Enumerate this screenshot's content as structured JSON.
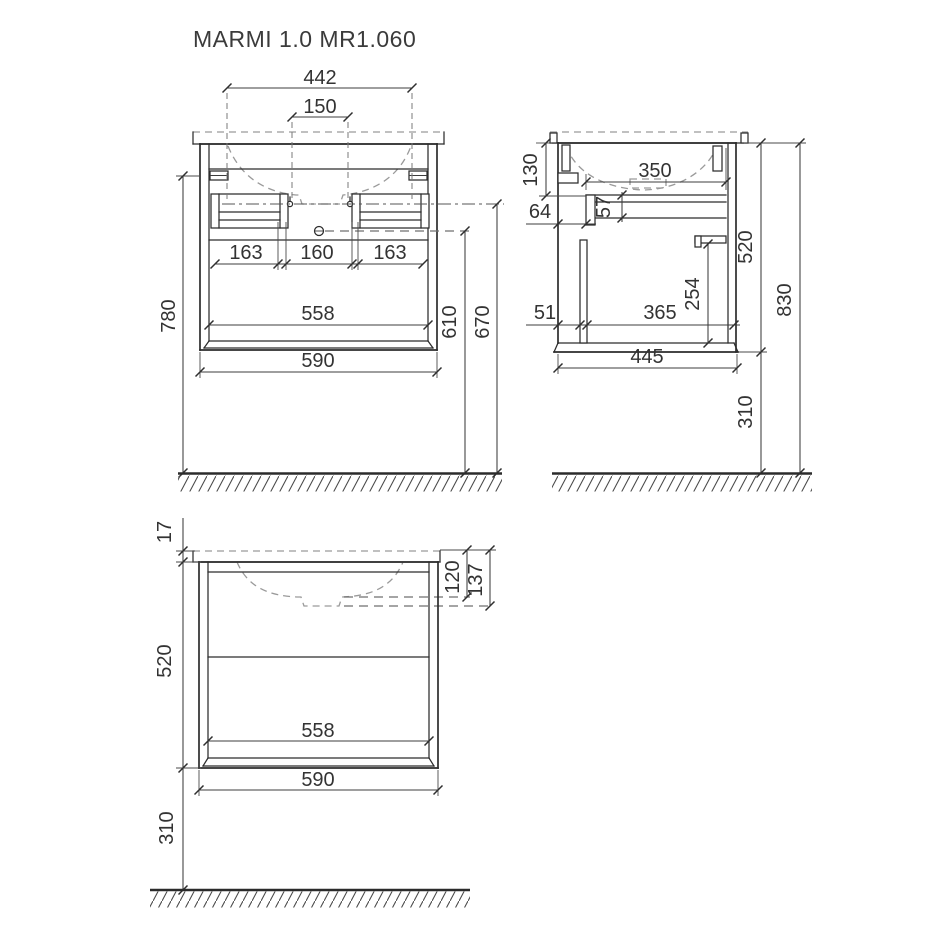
{
  "title": "MARMI 1.0 MR1.060",
  "front": {
    "d442": "442",
    "d150": "150",
    "d163a": "163",
    "d160": "160",
    "d163b": "163",
    "d558": "558",
    "d590": "590",
    "d780": "780",
    "d610": "610",
    "d670": "670"
  },
  "side": {
    "d130": "130",
    "d350": "350",
    "d64": "64",
    "d57": "57",
    "d51": "51",
    "d365": "365",
    "d254": "254",
    "d445": "445",
    "d520": "520",
    "d310": "310",
    "d830": "830"
  },
  "bottom": {
    "d17": "17",
    "d520": "520",
    "d310": "310",
    "d120": "120",
    "d137": "137",
    "d558": "558",
    "d590": "590"
  },
  "colors": {
    "line": "#2c2c2c",
    "dashed": "#9a9a9a",
    "text": "#333333",
    "background": "#ffffff"
  }
}
